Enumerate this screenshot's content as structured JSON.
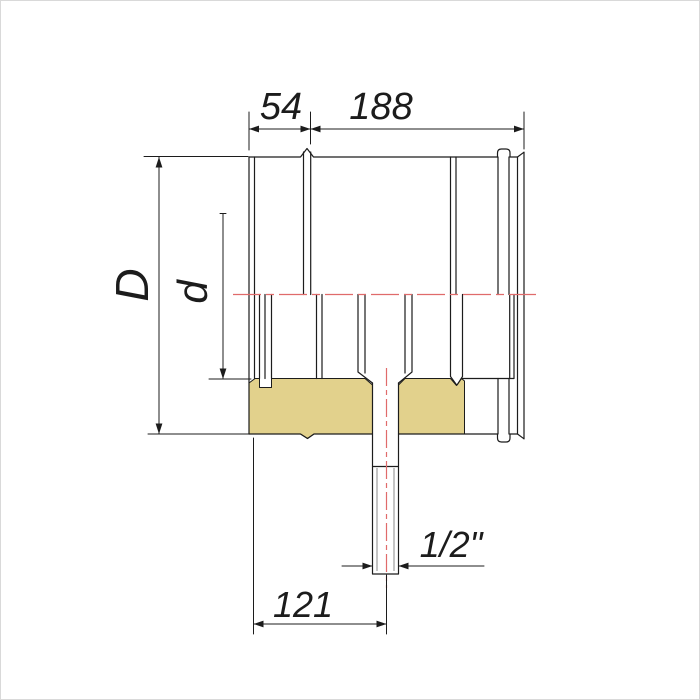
{
  "drawing": {
    "type": "technical section drawing of insulated pipe section with condensate drain",
    "dimensions": {
      "collar_length": "54",
      "body_length": "188",
      "outer_diameter": "D",
      "inner_diameter": "d",
      "drain_thread": "1/2\"",
      "drain_offset": "121"
    },
    "colors": {
      "line": "#1c1c1c",
      "centerline_red": "#e06b6b",
      "insulation_yellow": "#e2d18c",
      "thread_gray": "#8a8a8a",
      "background": "#ffffff"
    }
  }
}
